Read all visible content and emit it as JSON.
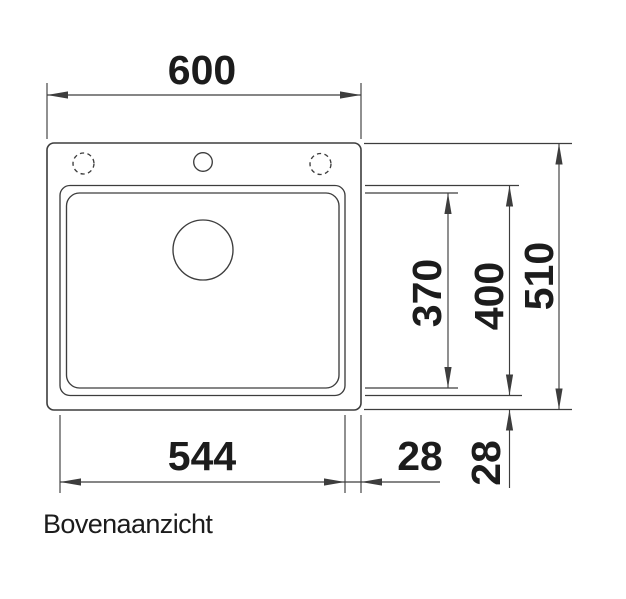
{
  "drawing": {
    "caption": "Bovenaanzicht",
    "dims": {
      "total_width": "600",
      "total_depth": "510",
      "bowl_depth_outer": "400",
      "bowl_depth_inner": "370",
      "bowl_width": "544",
      "gap_right": "28",
      "gap_bottom": "28"
    },
    "colors": {
      "line": "#3d3d3d",
      "text": "#1c1c1c",
      "background": "#ffffff"
    }
  }
}
